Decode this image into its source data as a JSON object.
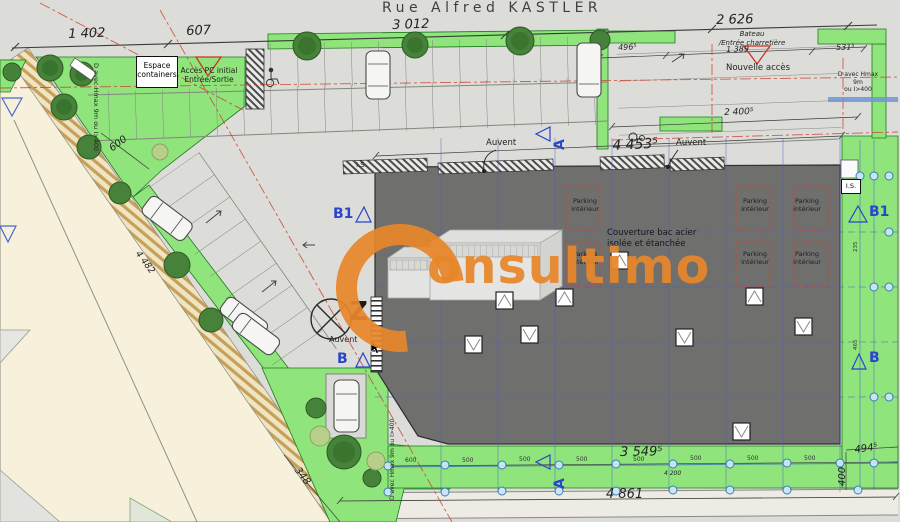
{
  "street": {
    "name": "Rue Alfred KASTLER"
  },
  "logo": {
    "company": "Consultimo",
    "wordmark_rest": "onsultimo",
    "color": "#E8872B"
  },
  "colors": {
    "landscape_green": "#8FE47B",
    "building_gray": "#6F6F6D",
    "road_beige": "#F7F0DA",
    "marker_blue": "#2A46C8",
    "boundary_red": "#CC4433",
    "logo_orange": "#E8872B"
  },
  "dimensions": {
    "top_left": "1 402",
    "top_access": "607",
    "street_front": "3 012",
    "top_right": "2 626",
    "right_1": "496⁵",
    "right_2": "1 389",
    "right_3": "531⁵",
    "right_depth": "2 400⁵",
    "building_front": "4 453⁵",
    "stall_depth": "600",
    "left_side": "4 482",
    "bottom_corner": "348",
    "building_rear": "3 549⁵",
    "rear_total": "4 861",
    "rear_right": "494⁵",
    "rear_strip": "400",
    "rear_sub": "4 200"
  },
  "grid": {
    "bottom_ticks": [
      "600",
      "500",
      "500",
      "500",
      "500",
      "500",
      "500",
      "500"
    ],
    "side_ticks": [
      "235",
      "465"
    ]
  },
  "annotations": {
    "espace_containers_1": "Espace",
    "espace_containers_2": "containers",
    "acces_pc_1": "Accès PC initial",
    "acces_pc_2": "Entrée/Sortie",
    "bateau_1": "Bateau",
    "bateau_2": "/Entrée charretière",
    "nouvelle_acces": "Nouvelle accès",
    "auvent": "Auvent",
    "is": "I.S.",
    "parking_interieur_1": "Parking",
    "parking_interieur_2": "intérieur",
    "couverture_1": "Couverture bac acier",
    "couverture_2": "isolée et étanchée",
    "hmax_full": "D avec Hmax 9m ou I>400",
    "hmax_1": "D avec Hmax 9m",
    "hmax_2": "ou I>400"
  },
  "markers": {
    "section_b1": "B1",
    "section_b": "B",
    "section_a": "A",
    "north": "Z"
  }
}
